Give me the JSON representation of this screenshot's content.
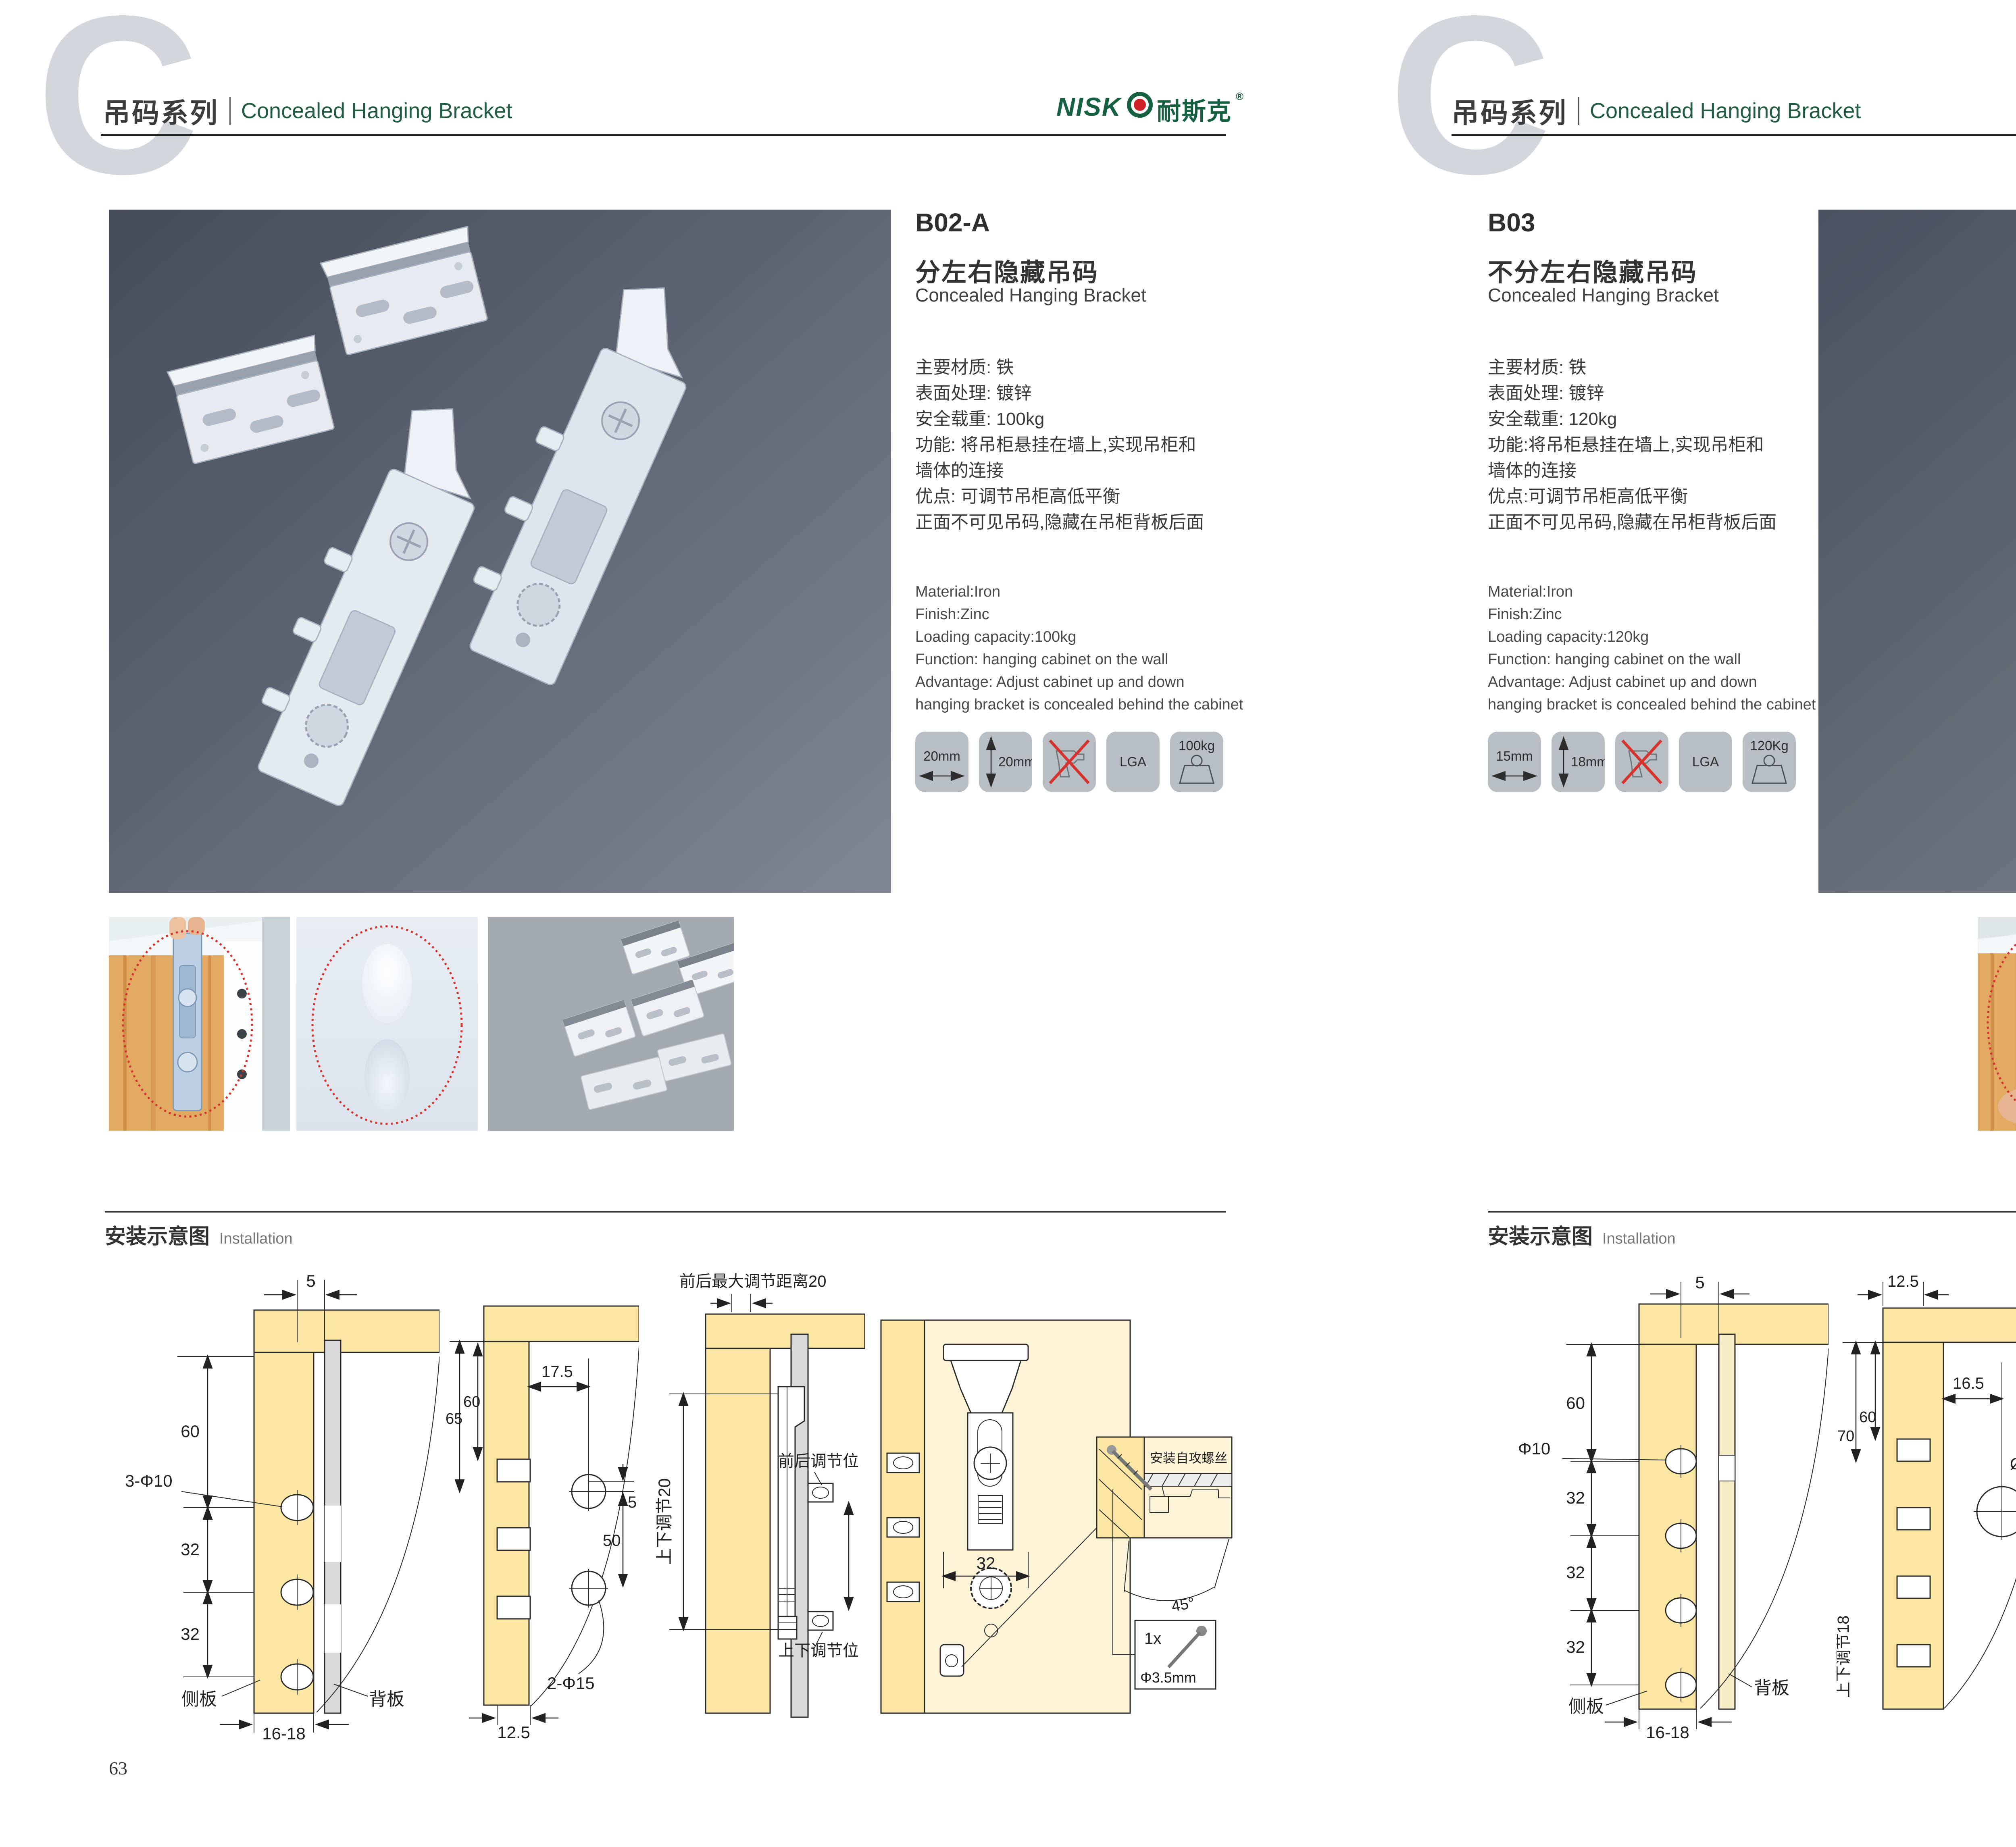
{
  "brand": {
    "letter": "C",
    "series_cn": "吊码系列",
    "series_en": "Concealed Hanging Bracket",
    "logo_latin": "NISK",
    "logo_cn": "耐斯克",
    "registered": "®"
  },
  "colors": {
    "accent_green": "#15603f",
    "photo_bg_dark": "#454c5a",
    "photo_bg_light": "#7f8795",
    "wood": "#fbe7a3",
    "red_marker": "#d5342e",
    "badge_bg": "#b9bec4"
  },
  "left_page": {
    "page_no": "63",
    "product": {
      "code": "B02-A",
      "title_cn": "分左右隐藏吊码",
      "title_en": "Concealed Hanging Bracket",
      "specs_cn": [
        "主要材质: 铁",
        "表面处理: 镀锌",
        "安全载重: 100kg",
        "功能: 将吊柜悬挂在墙上,实现吊柜和",
        "墙体的连接",
        "优点: 可调节吊柜高低平衡",
        "正面不可见吊码,隐藏在吊柜背板后面"
      ],
      "specs_en": [
        "Material:Iron",
        "Finish:Zinc",
        "Loading capacity:100kg",
        "Function: hanging cabinet on the wall",
        "Advantage: Adjust cabinet up and down",
        "hanging bracket is concealed behind the cabinet"
      ],
      "badges": {
        "width": "20mm",
        "height": "20mm",
        "no_drill": "no-drill-icon",
        "cert": "LGA",
        "load": "100kg"
      }
    },
    "installation": {
      "cn": "安装示意图",
      "en": "Installation",
      "d1": {
        "top": "5",
        "h1": "60",
        "hole": "3-Φ10",
        "h2": "32",
        "h3": "32",
        "side": "侧板",
        "back": "背板",
        "bottom": "16-18"
      },
      "d2": {
        "v1": "65",
        "v2": "60",
        "top": "17.5",
        "off": "5",
        "gap": "50",
        "hole": "2-Φ15",
        "bottom": "12.5"
      },
      "d3": {
        "title": "前后最大调节距离20",
        "vertical": "上下调节20",
        "front": "前后调节位",
        "updown": "上下调节位"
      },
      "d4": {
        "w": "32",
        "screw_note": "安装自攻螺丝",
        "angle": "45°",
        "qty": "1x",
        "dia": "Φ3.5mm"
      }
    }
  },
  "right_page": {
    "page_no": "64",
    "product": {
      "code": "B03",
      "title_cn": "不分左右隐藏吊码",
      "title_en": "Concealed Hanging Bracket",
      "specs_cn": [
        "主要材质: 铁",
        "表面处理: 镀锌",
        "安全载重: 120kg",
        "功能:将吊柜悬挂在墙上,实现吊柜和",
        "墙体的连接",
        "优点:可调节吊柜高低平衡",
        "正面不可见吊码,隐藏在吊柜背板后面"
      ],
      "specs_en": [
        "Material:Iron",
        "Finish:Zinc",
        "Loading capacity:120kg",
        "Function: hanging cabinet on the wall",
        "Advantage: Adjust cabinet up and down",
        "hanging bracket is concealed behind the cabinet"
      ],
      "badges": {
        "width": "15mm",
        "height": "18mm",
        "no_drill": "no-drill-icon",
        "cert": "LGA",
        "load": "120Kg"
      }
    },
    "installation": {
      "cn": "安装示意图",
      "en": "Installation",
      "d1": {
        "top": "5",
        "h1": "60",
        "hole": "Φ10",
        "h2": "32",
        "h3": "32",
        "h4": "32",
        "side": "侧板",
        "back": "背板",
        "bottom": "16-18"
      },
      "d2": {
        "top": "12.5",
        "v1": "70",
        "v2": "60",
        "inner": "16.5",
        "hole": "Ø 25",
        "off": "10",
        "vertical": "上下调节18"
      },
      "d3": {
        "top": "16.5",
        "left": "12.5",
        "off": "10",
        "hole": "ø25",
        "state": "锁紧状态"
      },
      "d4": {
        "screw_note": "安装自攻螺丝",
        "angle": "45°",
        "qty": "1x",
        "dia": "φ3.5mm"
      }
    }
  }
}
